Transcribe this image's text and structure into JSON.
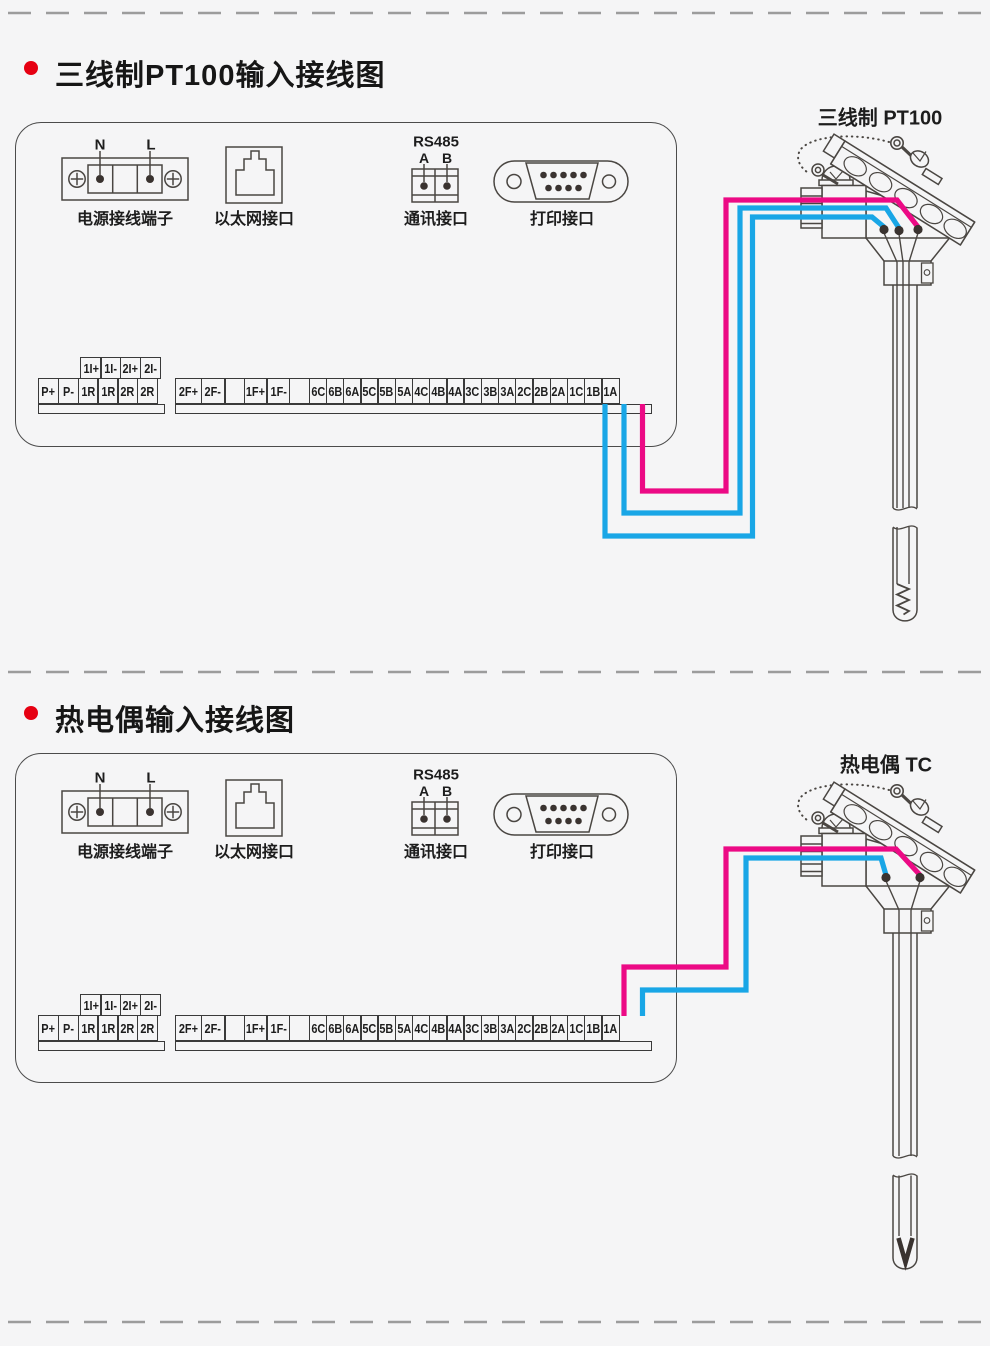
{
  "colors": {
    "wire_magenta": "#ec0a85",
    "wire_cyan": "#19a6e6",
    "bullet_red": "#e60012",
    "line_dark": "#4a4642"
  },
  "section1": {
    "title": "三线制PT100输入接线图",
    "sensor_label": "三线制 PT100",
    "power_label": "电源接线端子",
    "power_n": "N",
    "power_l": "L",
    "ethernet_label": "以太网接口",
    "rs485_title": "RS485",
    "rs485_a": "A",
    "rs485_b": "B",
    "comm_label": "通讯接口",
    "printer_label": "打印接口",
    "strip_aux": [
      "1I+",
      "1I-",
      "2I+",
      "2I-"
    ],
    "strip_left": [
      "P+",
      "P-",
      "1R",
      "1R",
      "2R",
      "2R"
    ],
    "strip_main": [
      "2F+",
      "2F-",
      "",
      "1F+",
      "1F-",
      "",
      "6C",
      "6B",
      "6A",
      "5C",
      "5B",
      "5A",
      "4C",
      "4B",
      "4A",
      "3C",
      "3B",
      "3A",
      "2C",
      "2B",
      "2A",
      "1C",
      "1B",
      "1A"
    ]
  },
  "section2": {
    "title": "热电偶输入接线图",
    "sensor_label": "热电偶 TC",
    "power_label": "电源接线端子",
    "power_n": "N",
    "power_l": "L",
    "ethernet_label": "以太网接口",
    "rs485_title": "RS485",
    "rs485_a": "A",
    "rs485_b": "B",
    "comm_label": "通讯接口",
    "printer_label": "打印接口",
    "strip_aux": [
      "1I+",
      "1I-",
      "2I+",
      "2I-"
    ],
    "strip_left": [
      "P+",
      "P-",
      "1R",
      "1R",
      "2R",
      "2R"
    ],
    "strip_main": [
      "2F+",
      "2F-",
      "",
      "1F+",
      "1F-",
      "",
      "6C",
      "6B",
      "6A",
      "5C",
      "5B",
      "5A",
      "4C",
      "4B",
      "4A",
      "3C",
      "3B",
      "3A",
      "2C",
      "2B",
      "2A",
      "1C",
      "1B",
      "1A"
    ]
  }
}
